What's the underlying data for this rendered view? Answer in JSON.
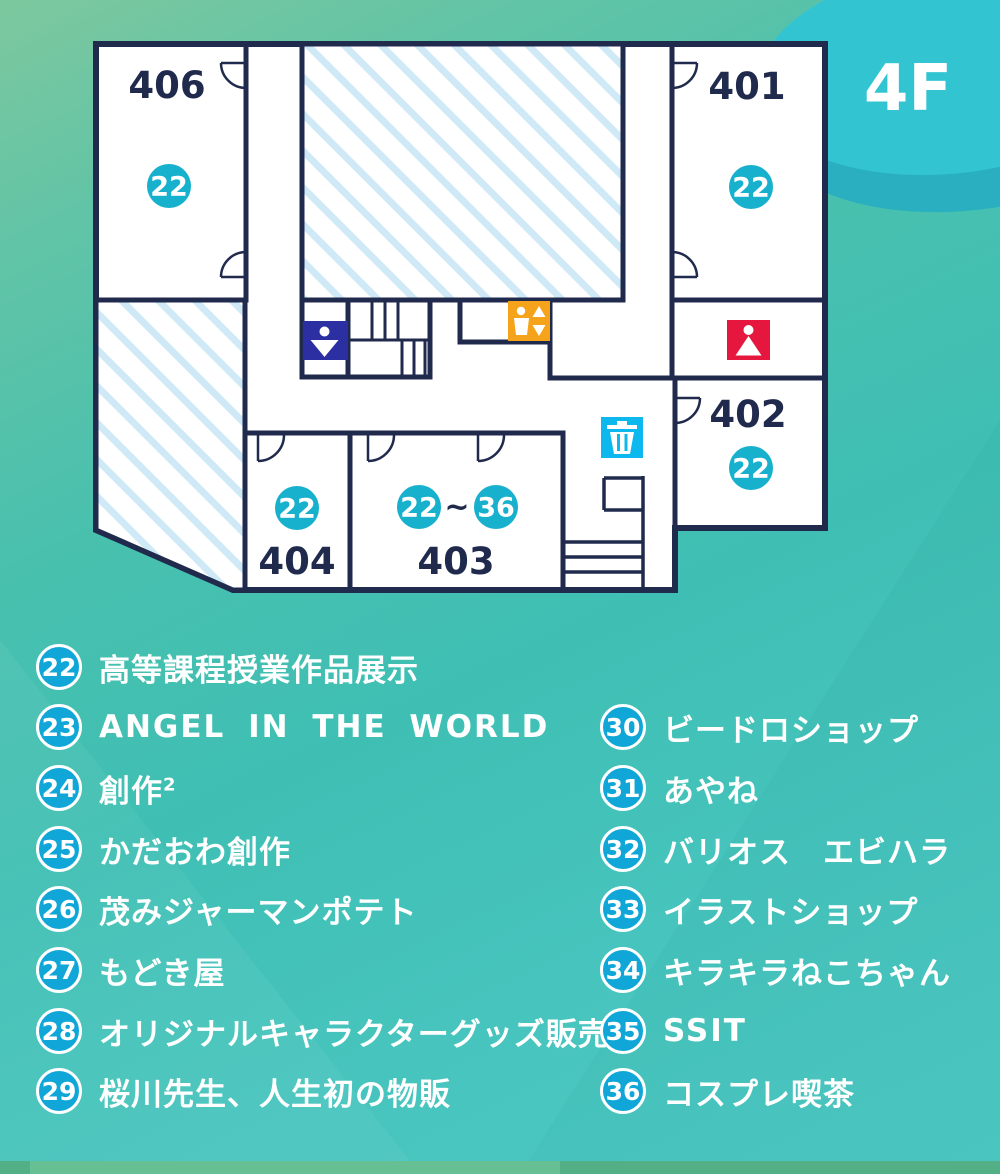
{
  "floor_label": "4F",
  "map": {
    "rooms": [
      {
        "number": "406",
        "booth": "22"
      },
      {
        "number": "401",
        "booth": "22"
      },
      {
        "number": "402",
        "booth": "22"
      },
      {
        "number": "403",
        "booth_from": "22",
        "booth_sep": "~",
        "booth_to": "36"
      },
      {
        "number": "404",
        "booth": "22"
      }
    ],
    "icons": [
      "mens-restroom-icon",
      "elevator-icon",
      "womens-restroom-icon",
      "trash-icon",
      "stairs",
      "door-arc"
    ]
  },
  "legend": {
    "left": [
      {
        "num": "22",
        "label": "高等課程授業作品展示"
      },
      {
        "num": "23",
        "label": "ANGEL IN THE WORLD"
      },
      {
        "num": "24",
        "label": "創作",
        "sup": "2"
      },
      {
        "num": "25",
        "label": "かだおわ創作"
      },
      {
        "num": "26",
        "label": "茂みジャーマンポテト"
      },
      {
        "num": "27",
        "label": "もどき屋"
      },
      {
        "num": "28",
        "label": "オリジナルキャラクターグッズ販売"
      },
      {
        "num": "29",
        "label": "桜川先生、人生初の物販"
      }
    ],
    "right": [
      {
        "num": "30",
        "label": "ビードロショップ"
      },
      {
        "num": "31",
        "label": "あやね"
      },
      {
        "num": "32",
        "label": "バリオス　エビハラ"
      },
      {
        "num": "33",
        "label": "イラストショップ"
      },
      {
        "num": "34",
        "label": "キラキラねこちゃん"
      },
      {
        "num": "35",
        "label": "SSIT"
      },
      {
        "num": "36",
        "label": "コスプレ喫茶"
      }
    ]
  },
  "colors": {
    "wall": "#202a4c",
    "hatch_stripe": "#cfeaf6",
    "map_badge": "#17b1ce",
    "legend_badge": "#10a7d8",
    "mens_restroom": "#2b2fa2",
    "womens_restroom": "#e6173e",
    "elevator": "#f4a31b",
    "trash": "#0cb8ee",
    "floor_badge": "#33c4d2"
  }
}
